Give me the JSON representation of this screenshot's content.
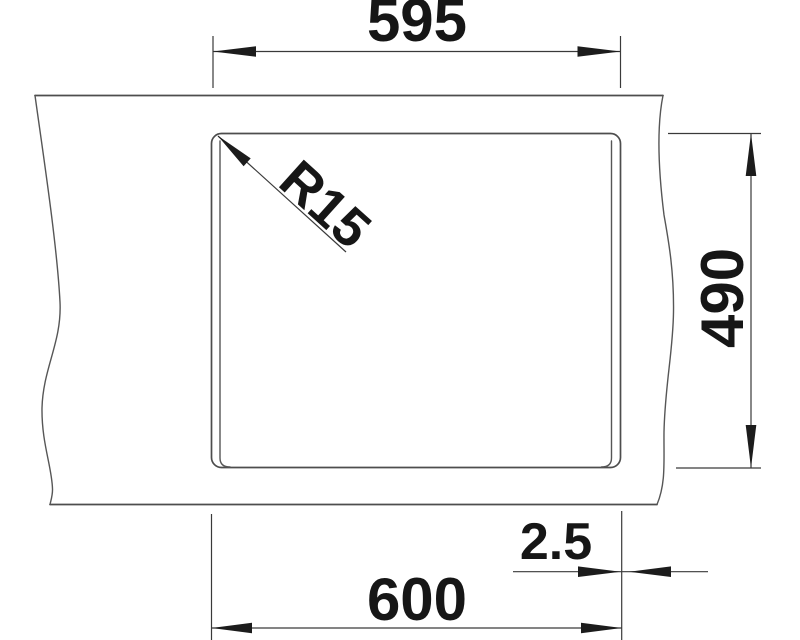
{
  "drawing": {
    "kind": "sink-cutout-dimension-drawing",
    "labels": {
      "cutout_width": "595",
      "corner_radius": "R15",
      "depth": "490",
      "edge_offset": "2.5",
      "overall_width": "600"
    },
    "colors": {
      "background": "#ffffff",
      "outline": "#4d4d4d",
      "dimension_line": "#3a3a3a",
      "text": "#161616"
    }
  }
}
